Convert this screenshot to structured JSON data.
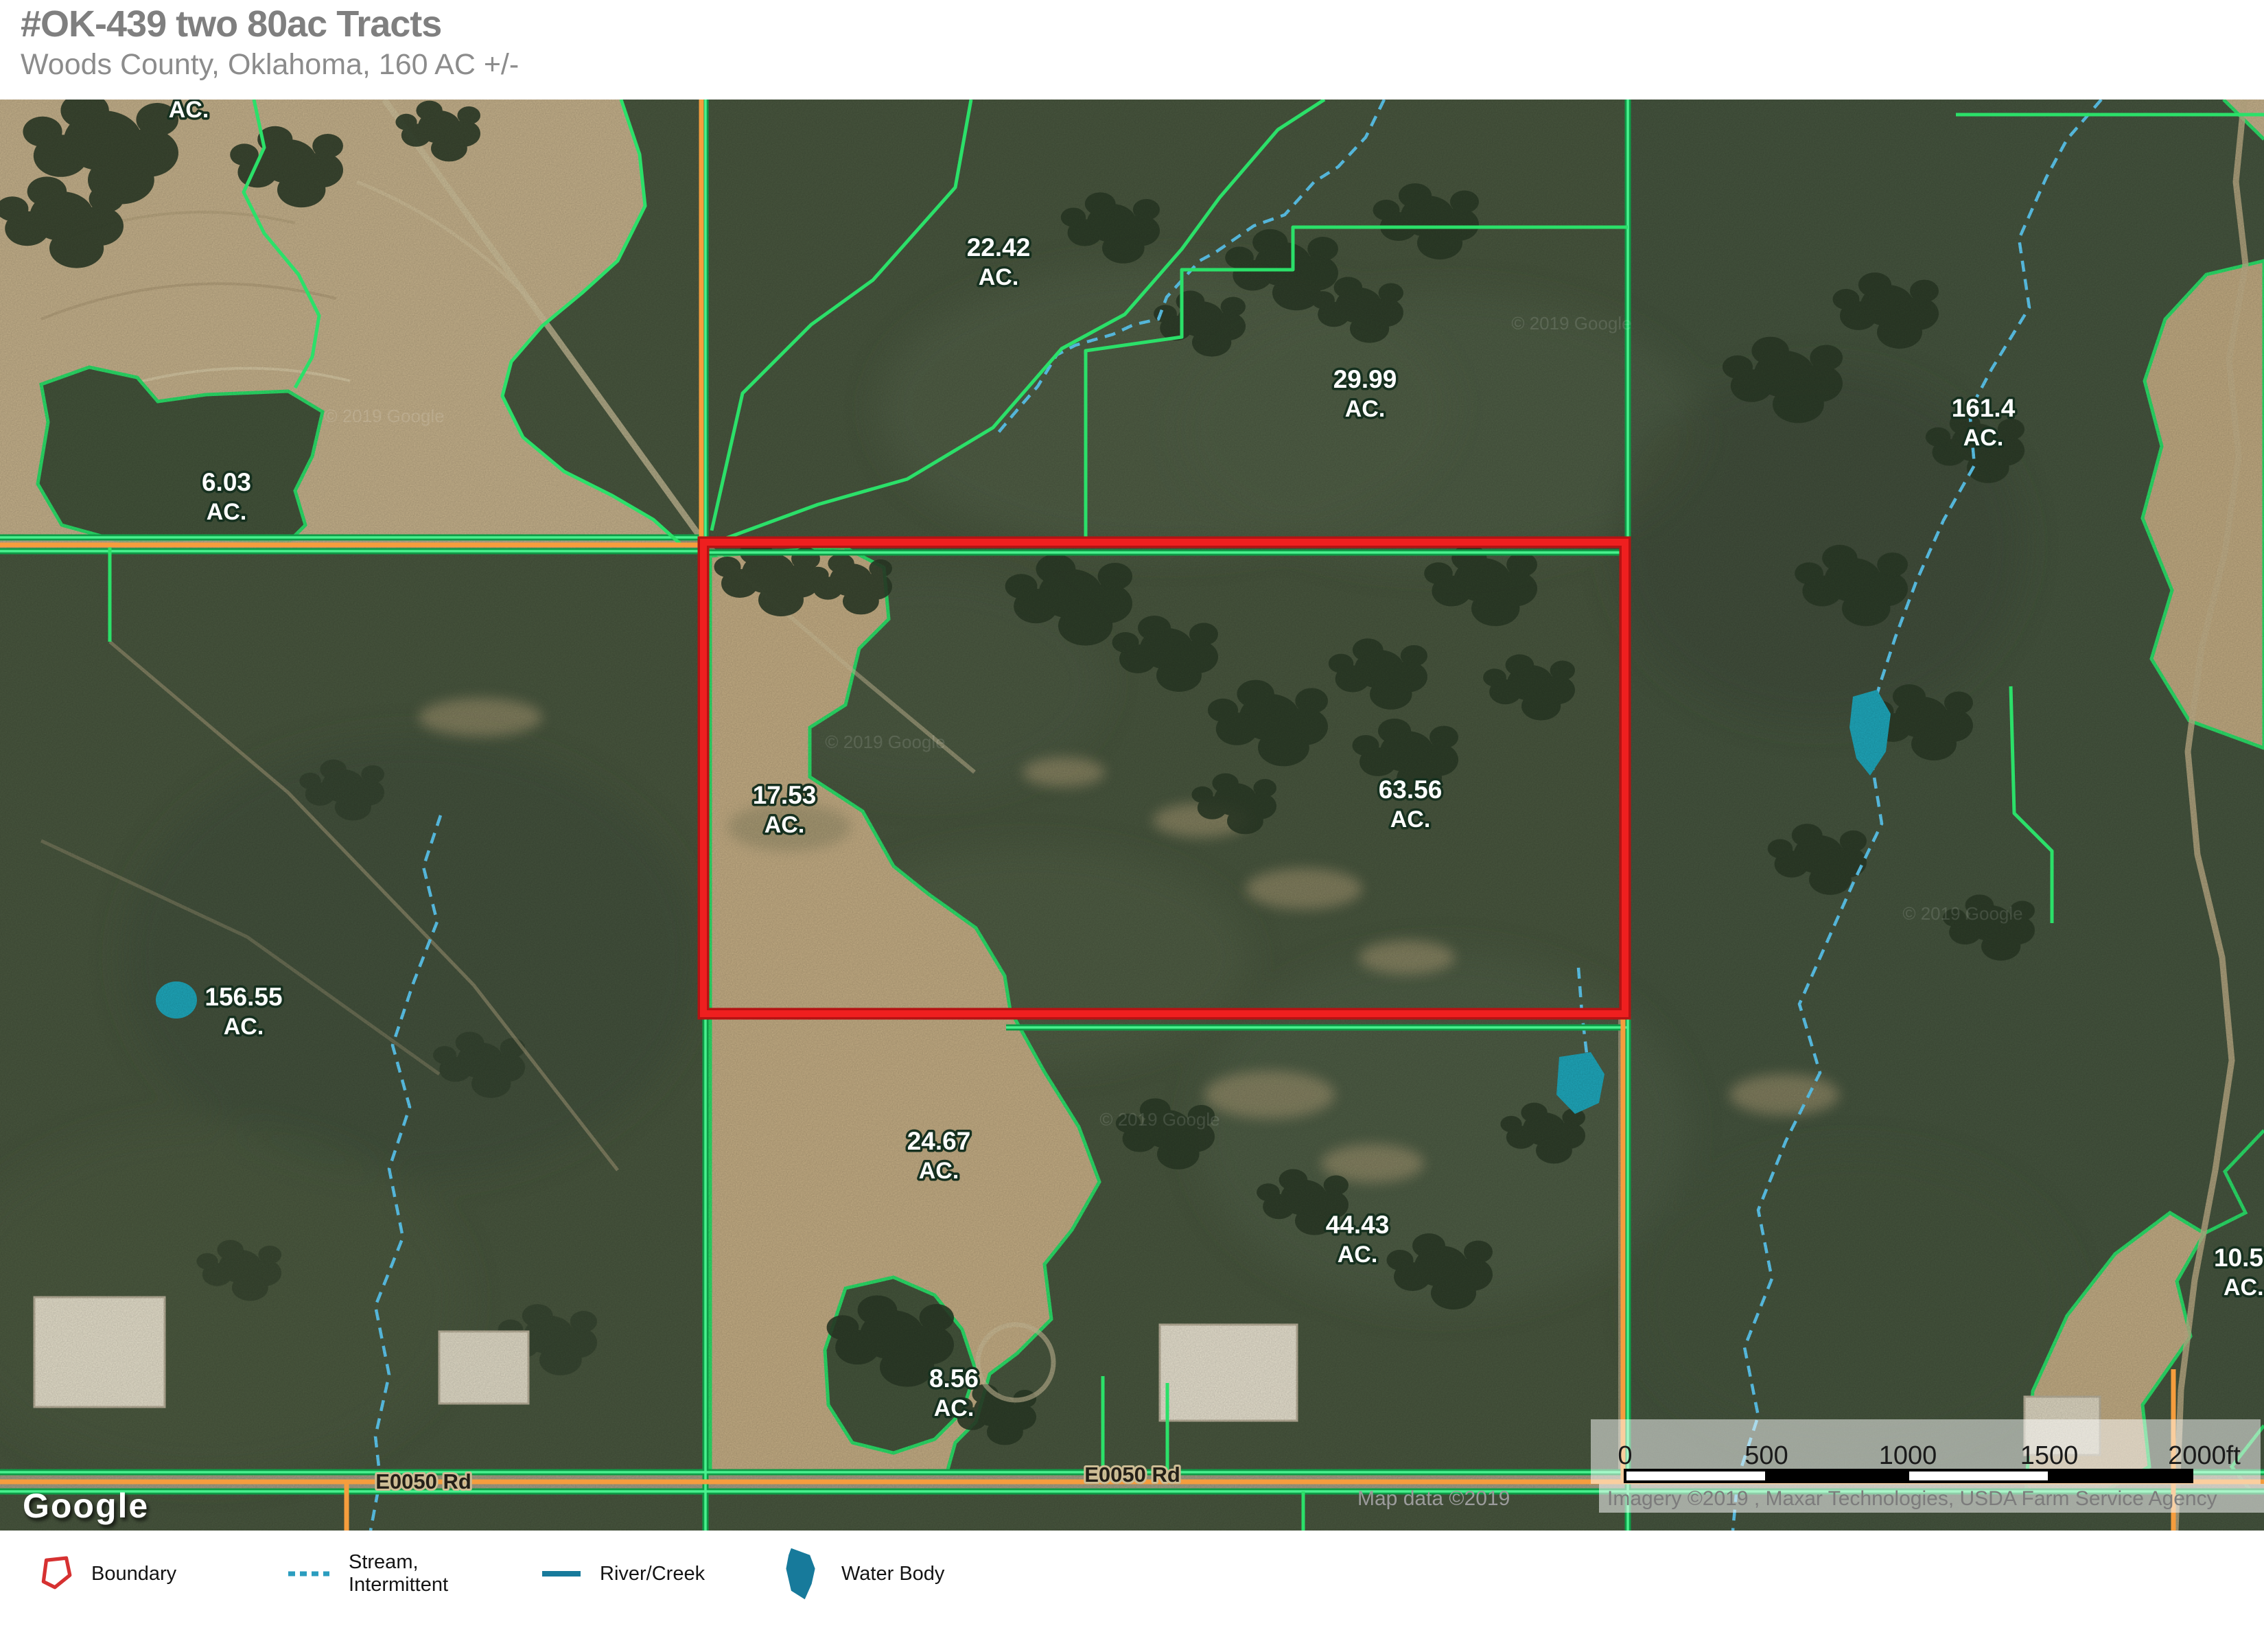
{
  "header": {
    "title": "#OK-439 two 80ac Tracts",
    "subtitle": "Woods County, Oklahoma, 160 AC +/-"
  },
  "map": {
    "top_partial_unit": "AC.",
    "acreage_labels": [
      {
        "value": "6.03",
        "unit": "AC."
      },
      {
        "value": "22.42",
        "unit": "AC."
      },
      {
        "value": "29.99",
        "unit": "AC."
      },
      {
        "value": "161.4",
        "unit": "AC."
      },
      {
        "value": "17.53",
        "unit": "AC."
      },
      {
        "value": "63.56",
        "unit": "AC."
      },
      {
        "value": "156.55",
        "unit": "AC."
      },
      {
        "value": "24.67",
        "unit": "AC."
      },
      {
        "value": "44.43",
        "unit": "AC."
      },
      {
        "value": "8.56",
        "unit": "AC."
      },
      {
        "value": "10.5",
        "unit": "AC."
      }
    ],
    "road_labels": [
      {
        "text": "E0050 Rd"
      },
      {
        "text": "E0050 Rd"
      }
    ],
    "watermark": "© 2019 Google",
    "google_logo": "Google",
    "scale_bar": {
      "labels": [
        "0",
        "500",
        "1000",
        "1500",
        "2000ft"
      ]
    },
    "attribution": {
      "map_data": "Map data ©2019",
      "imagery": "Imagery ©2019 , Maxar Technologies, USDA Farm Service Agency"
    }
  },
  "legend": {
    "items": [
      {
        "label": "Boundary"
      },
      {
        "label_line1": "Stream,",
        "label_line2": "Intermittent"
      },
      {
        "label": "River/Creek"
      },
      {
        "label": "Water Body"
      }
    ]
  },
  "colors": {
    "boundary_red": "#e8191c",
    "parcel_green": "#2be069",
    "road_orange": "#f59d3d",
    "stream_blue": "#5fcdf5",
    "water_teal": "#1fa9bd",
    "legend_teal": "#17799a",
    "title_gray": "#7f7f7f"
  }
}
